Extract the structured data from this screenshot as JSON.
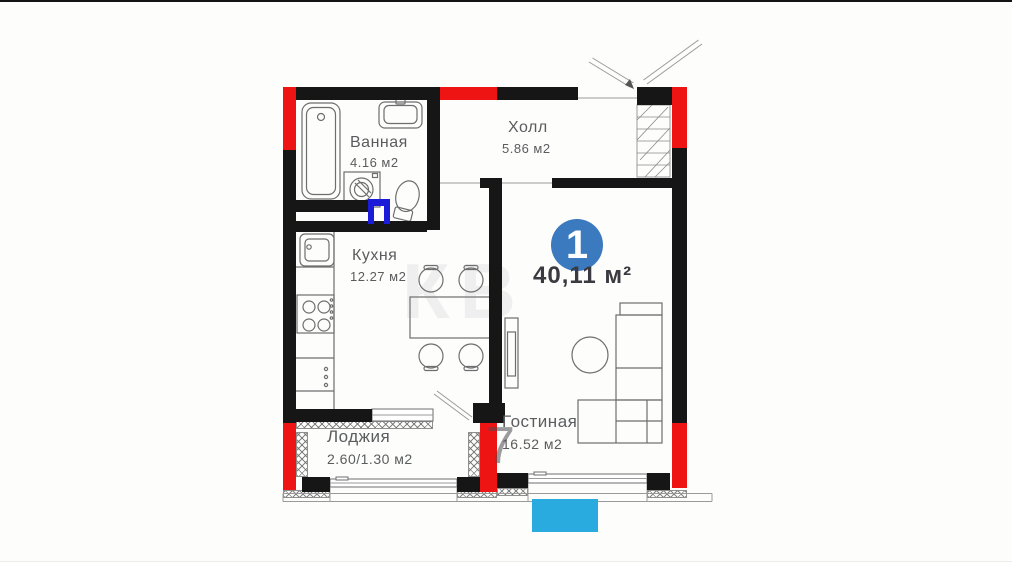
{
  "palette": {
    "wall": "#161616",
    "red": "#ee1414",
    "door_blue": "#1c1cd8",
    "badge_blue": "#3b7abf",
    "cyan": "#29abdf",
    "line_gray": "#6e6e6e",
    "label_gray": "#5b5c5e"
  },
  "unit": {
    "badge_number": "1",
    "total_area": "40,11 м²"
  },
  "rooms": [
    {
      "name": "Ванная",
      "area": "4.16 м2"
    },
    {
      "name": "Холл",
      "area": "5.86 м2"
    },
    {
      "name": "Кухня",
      "area": "12.27 м2"
    },
    {
      "name": "Гостиная",
      "area": "16.52 м2"
    },
    {
      "name": "Лоджия",
      "area": "2.60/1.30 м2"
    }
  ],
  "watermark": {
    "digit": "7",
    "letters": "КВ"
  }
}
